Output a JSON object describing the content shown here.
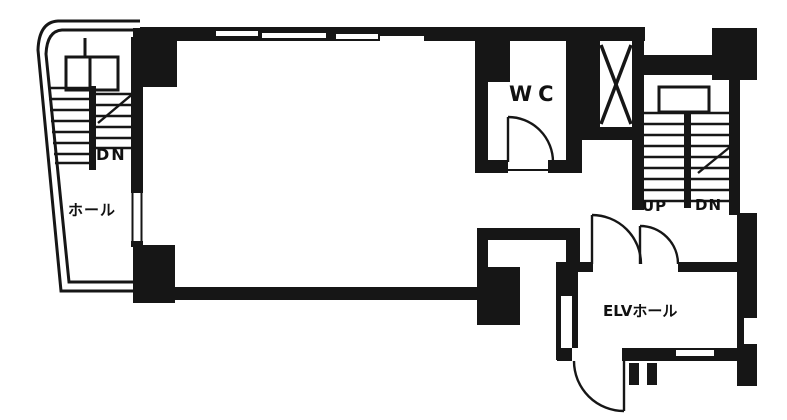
{
  "plan": {
    "type": "floor-plan",
    "labels": {
      "left_stair_dn": "DN",
      "left_hall": "ホール",
      "wc": "WC",
      "right_stair_up": "UP",
      "right_stair_dn": "DN",
      "elevator_hall": "ELVホール"
    },
    "colors": {
      "wall": "#161616",
      "background": "#ffffff"
    }
  }
}
